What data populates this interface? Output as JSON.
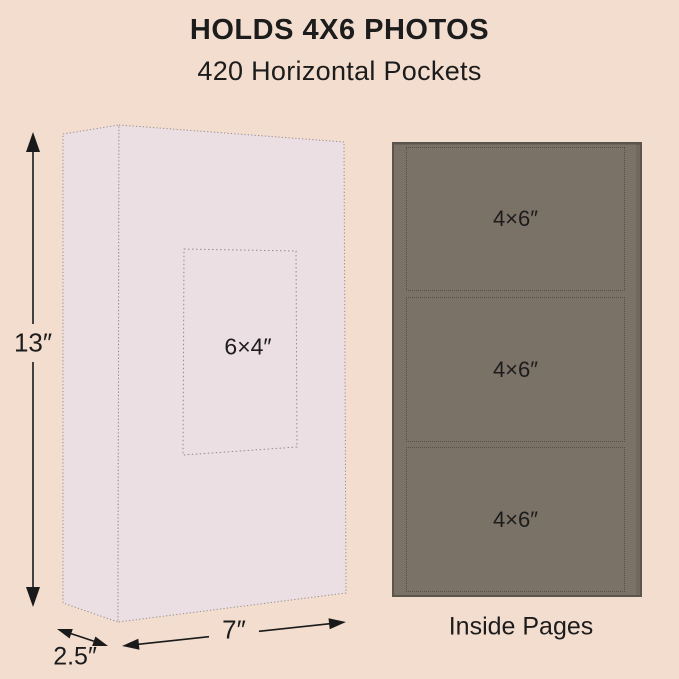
{
  "title": "HOLDS 4X6 PHOTOS",
  "subtitle": "420 Horizontal Pockets",
  "colors": {
    "background": "#f2ddcf",
    "album_fill": "#ecdfe3",
    "outline": "#948a8d",
    "page_fill": "#7b7267",
    "page_border": "#5c554d",
    "pocket_line": "#564f48",
    "arrow": "#1a1a1a",
    "text": "#1c1c1c"
  },
  "album_diagram": {
    "height_label": "13″",
    "width_label": "7″",
    "depth_label": "2.5″",
    "cover_window_label": "6×4″"
  },
  "inside_pages": {
    "caption": "Inside Pages",
    "pockets": [
      {
        "label": "4×6″"
      },
      {
        "label": "4×6″"
      },
      {
        "label": "4×6″"
      }
    ]
  }
}
